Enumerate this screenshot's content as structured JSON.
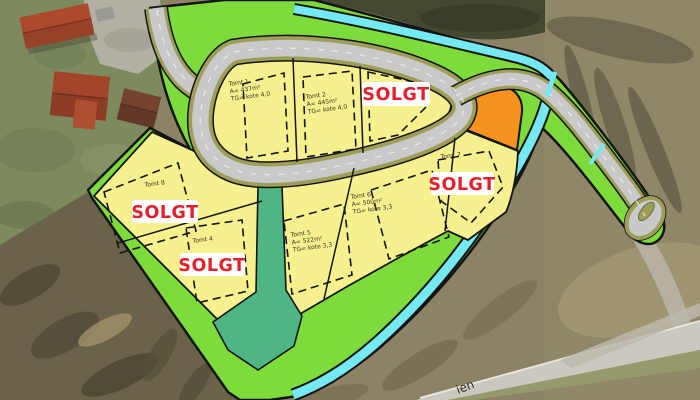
{
  "plan": {
    "sold_label": "SOLGT",
    "plots": [
      {
        "name": "Tomt 1",
        "area": "A= 437m²",
        "ground": "TG= kote 4,0",
        "status": ""
      },
      {
        "name": "Tomt 2",
        "area": "A= 445m²",
        "ground": "TG= kote 4,0",
        "status": ""
      },
      {
        "name": "",
        "area": "",
        "ground": "",
        "status": "SOLGT"
      },
      {
        "name": "Tomt 4",
        "area": "",
        "ground": "",
        "status": "SOLGT"
      },
      {
        "name": "Tomt 5",
        "area": "A= 522m²",
        "ground": "TG= kote 3,3",
        "status": ""
      },
      {
        "name": "Tomt 6",
        "area": "A= 500m²",
        "ground": "TG= kote 3,3",
        "status": ""
      },
      {
        "name": "Tomt 7",
        "area": "",
        "ground": "",
        "status": "SOLGT"
      },
      {
        "name": "Tomt 8",
        "area": "",
        "ground": "",
        "status": "SOLGT"
      }
    ],
    "colors": {
      "plot_yellow": "#F7F08E",
      "road_gray": "#C9C9C9",
      "road_edge_olive": "#9D9E58",
      "green_area": "#7DDC3C",
      "teal_area": "#4FB585",
      "stream_cyan": "#74E9F2",
      "orange_plot": "#F6921E",
      "sold_red": "#E4202D",
      "outline_black": "#141414"
    }
  },
  "map": {
    "street_label_partial": "ien"
  }
}
